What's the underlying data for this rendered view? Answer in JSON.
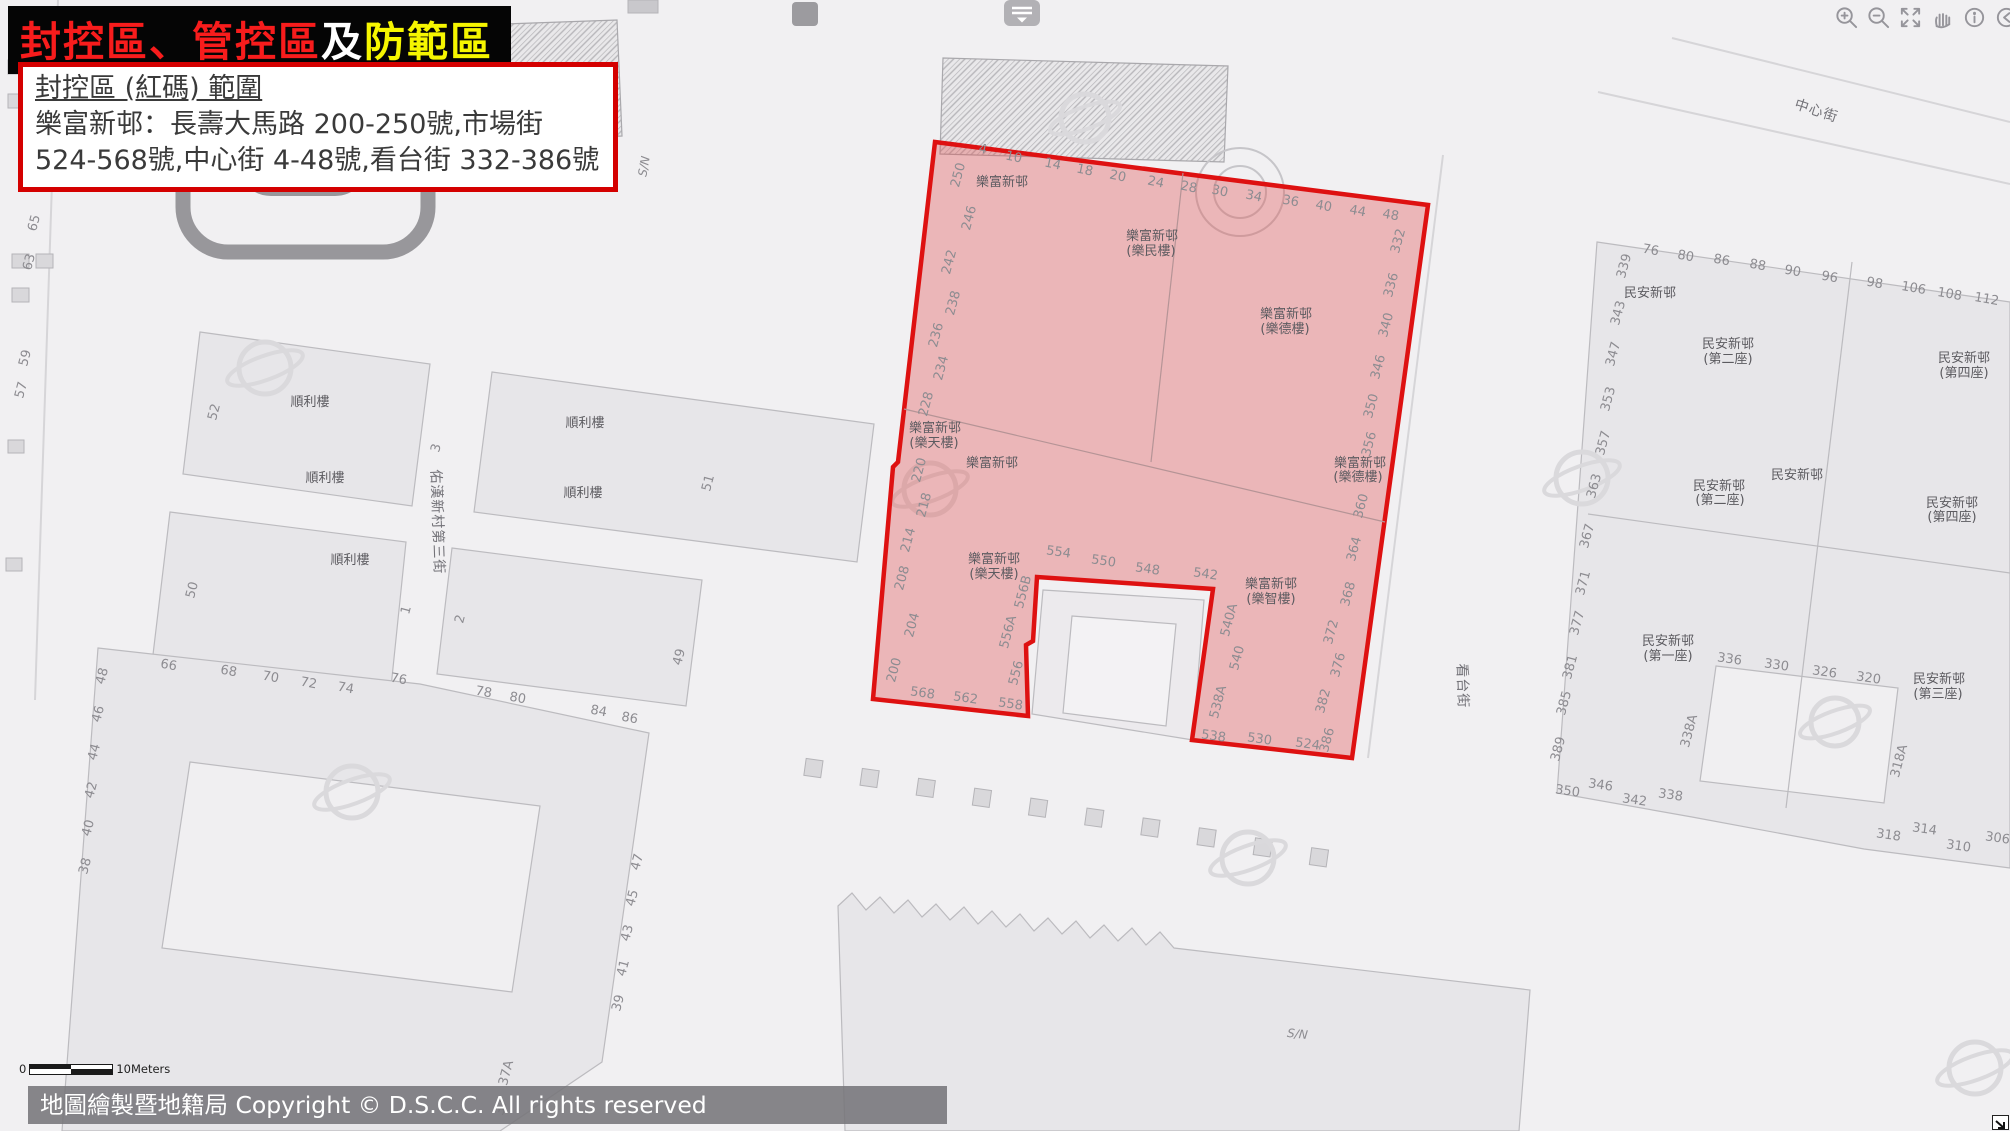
{
  "banner": {
    "red": "封控區、管控區",
    "white": "及",
    "yellow": "防範區"
  },
  "info_box": {
    "title": "封控區 (紅碼) 範圍",
    "line1": "樂富新邨：長壽大馬路 200-250號,市場街",
    "line2": "524-568號,中心街 4-48號,看台街 332-386號"
  },
  "toolbar": {
    "collapse_icon": "panel-collapse",
    "icons": [
      "zoom-in",
      "zoom-out",
      "full-extent",
      "pan-hand",
      "identify-info",
      "previous-extent",
      "next-extent"
    ]
  },
  "scalebar": {
    "zero": "0",
    "label": "10Meters"
  },
  "attribution": "地圖繪製暨地籍局 Copyright © D.S.C.C. All rights reserved",
  "colors": {
    "zone_fill": "rgba(225,80,80,0.36)",
    "zone_border": "#de1111",
    "banner_red": "#f81c1c",
    "banner_yellow": "#f6f600"
  },
  "map": {
    "zone_name": "封控區",
    "labels": [
      {
        "t": "4",
        "x": 982,
        "y": 153,
        "r": 12
      },
      {
        "t": "10",
        "x": 1013,
        "y": 161,
        "r": 12
      },
      {
        "t": "14",
        "x": 1052,
        "y": 168,
        "r": 12
      },
      {
        "t": "18",
        "x": 1084,
        "y": 174,
        "r": 12
      },
      {
        "t": "20",
        "x": 1117,
        "y": 180,
        "r": 12
      },
      {
        "t": "24",
        "x": 1155,
        "y": 186,
        "r": 12
      },
      {
        "t": "28",
        "x": 1188,
        "y": 191,
        "r": 12
      },
      {
        "t": "30",
        "x": 1219,
        "y": 195,
        "r": 12
      },
      {
        "t": "34",
        "x": 1253,
        "y": 200,
        "r": 12
      },
      {
        "t": "36",
        "x": 1290,
        "y": 205,
        "r": 10
      },
      {
        "t": "40",
        "x": 1323,
        "y": 210,
        "r": 10
      },
      {
        "t": "44",
        "x": 1357,
        "y": 215,
        "r": 10
      },
      {
        "t": "48",
        "x": 1390,
        "y": 219,
        "r": 10
      },
      {
        "t": "250",
        "x": 962,
        "y": 176,
        "r": -75
      },
      {
        "t": "246",
        "x": 973,
        "y": 219,
        "r": -75
      },
      {
        "t": "242",
        "x": 953,
        "y": 263,
        "r": -75
      },
      {
        "t": "238",
        "x": 957,
        "y": 304,
        "r": -75
      },
      {
        "t": "236",
        "x": 940,
        "y": 336,
        "r": -75
      },
      {
        "t": "234",
        "x": 945,
        "y": 369,
        "r": -75
      },
      {
        "t": "228",
        "x": 930,
        "y": 405,
        "r": -75
      },
      {
        "t": "220",
        "x": 923,
        "y": 471,
        "r": -75
      },
      {
        "t": "218",
        "x": 928,
        "y": 506,
        "r": -75
      },
      {
        "t": "214",
        "x": 912,
        "y": 541,
        "r": -75
      },
      {
        "t": "208",
        "x": 906,
        "y": 579,
        "r": -75
      },
      {
        "t": "204",
        "x": 916,
        "y": 626,
        "r": -75
      },
      {
        "t": "200",
        "x": 898,
        "y": 671,
        "r": -75
      },
      {
        "t": "568",
        "x": 922,
        "y": 697,
        "r": 8
      },
      {
        "t": "562",
        "x": 965,
        "y": 702,
        "r": 8
      },
      {
        "t": "558",
        "x": 1010,
        "y": 708,
        "r": 8
      },
      {
        "t": "556",
        "x": 1020,
        "y": 674,
        "r": -75
      },
      {
        "t": "556A",
        "x": 1012,
        "y": 633,
        "r": -75
      },
      {
        "t": "556B",
        "x": 1027,
        "y": 593,
        "r": -75
      },
      {
        "t": "554",
        "x": 1058,
        "y": 556,
        "r": 8
      },
      {
        "t": "550",
        "x": 1103,
        "y": 565,
        "r": 8
      },
      {
        "t": "548",
        "x": 1147,
        "y": 573,
        "r": 8
      },
      {
        "t": "542",
        "x": 1205,
        "y": 578,
        "r": 8
      },
      {
        "t": "540A",
        "x": 1233,
        "y": 621,
        "r": -75
      },
      {
        "t": "540",
        "x": 1241,
        "y": 659,
        "r": -75
      },
      {
        "t": "538A",
        "x": 1222,
        "y": 703,
        "r": -75
      },
      {
        "t": "538",
        "x": 1213,
        "y": 740,
        "r": 8
      },
      {
        "t": "530",
        "x": 1259,
        "y": 743,
        "r": 8
      },
      {
        "t": "524",
        "x": 1307,
        "y": 748,
        "r": 8
      },
      {
        "t": "386",
        "x": 1331,
        "y": 741,
        "r": -75
      },
      {
        "t": "382",
        "x": 1327,
        "y": 702,
        "r": -75
      },
      {
        "t": "376",
        "x": 1342,
        "y": 666,
        "r": -75
      },
      {
        "t": "372",
        "x": 1335,
        "y": 633,
        "r": -75
      },
      {
        "t": "368",
        "x": 1352,
        "y": 595,
        "r": -75
      },
      {
        "t": "364",
        "x": 1358,
        "y": 550,
        "r": -75
      },
      {
        "t": "360",
        "x": 1365,
        "y": 507,
        "r": -75
      },
      {
        "t": "356",
        "x": 1373,
        "y": 445,
        "r": -75
      },
      {
        "t": "350",
        "x": 1375,
        "y": 407,
        "r": -75
      },
      {
        "t": "346",
        "x": 1382,
        "y": 368,
        "r": -75
      },
      {
        "t": "340",
        "x": 1390,
        "y": 326,
        "r": -75
      },
      {
        "t": "336",
        "x": 1395,
        "y": 286,
        "r": -75
      },
      {
        "t": "332",
        "x": 1402,
        "y": 242,
        "r": -75
      },
      {
        "t": "樂富新邨",
        "x": 1002,
        "y": 186,
        "c": "bld"
      },
      {
        "t": "樂富新邨",
        "x": 1152,
        "y": 240,
        "c": "bld"
      },
      {
        "t": "(樂民樓)",
        "x": 1151,
        "y": 255,
        "c": "bld"
      },
      {
        "t": "樂富新邨",
        "x": 1286,
        "y": 318,
        "c": "bld"
      },
      {
        "t": "(樂德樓)",
        "x": 1285,
        "y": 333,
        "c": "bld"
      },
      {
        "t": "樂富新邨",
        "x": 935,
        "y": 432,
        "c": "bld"
      },
      {
        "t": "(樂天樓)",
        "x": 934,
        "y": 447,
        "c": "bld"
      },
      {
        "t": "樂富新邨",
        "x": 992,
        "y": 467,
        "c": "bld"
      },
      {
        "t": "樂富新邨",
        "x": 994,
        "y": 563,
        "c": "bld"
      },
      {
        "t": "(樂天樓)",
        "x": 994,
        "y": 578,
        "c": "bld"
      },
      {
        "t": "樂富新邨",
        "x": 1360,
        "y": 467,
        "c": "bld"
      },
      {
        "t": "(樂德樓)",
        "x": 1358,
        "y": 481,
        "c": "bld"
      },
      {
        "t": "樂富新邨",
        "x": 1271,
        "y": 588,
        "c": "bld"
      },
      {
        "t": "(樂智樓)",
        "x": 1271,
        "y": 603,
        "c": "bld"
      },
      {
        "t": "順利樓",
        "x": 310,
        "y": 406,
        "c": "bld"
      },
      {
        "t": "順利樓",
        "x": 325,
        "y": 482,
        "c": "bld"
      },
      {
        "t": "順利樓",
        "x": 585,
        "y": 427,
        "c": "bld"
      },
      {
        "t": "順利樓",
        "x": 583,
        "y": 497,
        "c": "bld"
      },
      {
        "t": "順利樓",
        "x": 350,
        "y": 564,
        "c": "bld"
      },
      {
        "t": "52",
        "x": 218,
        "y": 413,
        "r": -75
      },
      {
        "t": "3",
        "x": 440,
        "y": 449,
        "r": -75
      },
      {
        "t": "51",
        "x": 712,
        "y": 484,
        "r": -75
      },
      {
        "t": "50",
        "x": 196,
        "y": 591,
        "r": -75
      },
      {
        "t": "1",
        "x": 410,
        "y": 611,
        "r": -75
      },
      {
        "t": "2",
        "x": 464,
        "y": 620,
        "r": -75
      },
      {
        "t": "49",
        "x": 683,
        "y": 658,
        "r": -75
      },
      {
        "t": "65",
        "x": 38,
        "y": 224,
        "r": -75
      },
      {
        "t": "63",
        "x": 33,
        "y": 263,
        "r": -75
      },
      {
        "t": "59",
        "x": 29,
        "y": 359,
        "r": -75
      },
      {
        "t": "57",
        "x": 25,
        "y": 391,
        "r": -75
      },
      {
        "t": "66",
        "x": 168,
        "y": 669,
        "r": 10
      },
      {
        "t": "68",
        "x": 228,
        "y": 675,
        "r": 10
      },
      {
        "t": "70",
        "x": 270,
        "y": 681,
        "r": 10
      },
      {
        "t": "72",
        "x": 308,
        "y": 687,
        "r": 10
      },
      {
        "t": "74",
        "x": 345,
        "y": 692,
        "r": 10
      },
      {
        "t": "76",
        "x": 398,
        "y": 683,
        "r": 10
      },
      {
        "t": "78",
        "x": 483,
        "y": 696,
        "r": 10
      },
      {
        "t": "80",
        "x": 517,
        "y": 702,
        "r": 10
      },
      {
        "t": "84",
        "x": 598,
        "y": 715,
        "r": 10
      },
      {
        "t": "86",
        "x": 629,
        "y": 722,
        "r": 10
      },
      {
        "t": "48",
        "x": 106,
        "y": 677,
        "r": -75
      },
      {
        "t": "46",
        "x": 102,
        "y": 715,
        "r": -75
      },
      {
        "t": "44",
        "x": 98,
        "y": 753,
        "r": -75
      },
      {
        "t": "42",
        "x": 95,
        "y": 791,
        "r": -75
      },
      {
        "t": "40",
        "x": 92,
        "y": 829,
        "r": -75
      },
      {
        "t": "38",
        "x": 89,
        "y": 867,
        "r": -75
      },
      {
        "t": "47",
        "x": 641,
        "y": 863,
        "r": -75
      },
      {
        "t": "45",
        "x": 636,
        "y": 899,
        "r": -75
      },
      {
        "t": "43",
        "x": 631,
        "y": 934,
        "r": -75
      },
      {
        "t": "41",
        "x": 627,
        "y": 969,
        "r": -75
      },
      {
        "t": "39",
        "x": 622,
        "y": 1004,
        "r": -75
      },
      {
        "t": "37A",
        "x": 510,
        "y": 1074,
        "r": -75
      },
      {
        "t": "37",
        "x": 505,
        "y": 1108,
        "r": -75
      },
      {
        "t": "民安新邨",
        "x": 1650,
        "y": 297,
        "c": "bld"
      },
      {
        "t": "民安新邨",
        "x": 1728,
        "y": 348,
        "c": "bld"
      },
      {
        "t": "(第二座)",
        "x": 1728,
        "y": 363,
        "c": "bld"
      },
      {
        "t": "民安新邨",
        "x": 1964,
        "y": 362,
        "c": "bld"
      },
      {
        "t": "(第四座)",
        "x": 1964,
        "y": 377,
        "c": "bld"
      },
      {
        "t": "民安新邨",
        "x": 1797,
        "y": 479,
        "c": "bld"
      },
      {
        "t": "民安新邨",
        "x": 1719,
        "y": 490,
        "c": "bld"
      },
      {
        "t": "(第二座)",
        "x": 1720,
        "y": 504,
        "c": "bld"
      },
      {
        "t": "民安新邨",
        "x": 1952,
        "y": 507,
        "c": "bld"
      },
      {
        "t": "(第四座)",
        "x": 1952,
        "y": 521,
        "c": "bld"
      },
      {
        "t": "民安新邨",
        "x": 1668,
        "y": 645,
        "c": "bld"
      },
      {
        "t": "(第一座)",
        "x": 1668,
        "y": 660,
        "c": "bld"
      },
      {
        "t": "民安新邨",
        "x": 1939,
        "y": 683,
        "c": "bld"
      },
      {
        "t": "(第三座)",
        "x": 1938,
        "y": 698,
        "c": "bld"
      },
      {
        "t": "76",
        "x": 1650,
        "y": 254,
        "r": 10
      },
      {
        "t": "80",
        "x": 1685,
        "y": 260,
        "r": 10
      },
      {
        "t": "86",
        "x": 1721,
        "y": 264,
        "r": 10
      },
      {
        "t": "88",
        "x": 1757,
        "y": 269,
        "r": 10
      },
      {
        "t": "90",
        "x": 1792,
        "y": 275,
        "r": 10
      },
      {
        "t": "96",
        "x": 1829,
        "y": 281,
        "r": 10
      },
      {
        "t": "98",
        "x": 1874,
        "y": 287,
        "r": 10
      },
      {
        "t": "106",
        "x": 1913,
        "y": 292,
        "r": 10
      },
      {
        "t": "108",
        "x": 1949,
        "y": 298,
        "r": 10
      },
      {
        "t": "112",
        "x": 1986,
        "y": 303,
        "r": 10
      },
      {
        "t": "339",
        "x": 1628,
        "y": 267,
        "r": -75
      },
      {
        "t": "343",
        "x": 1622,
        "y": 314,
        "r": -75
      },
      {
        "t": "347",
        "x": 1617,
        "y": 355,
        "r": -75
      },
      {
        "t": "353",
        "x": 1612,
        "y": 400,
        "r": -75
      },
      {
        "t": "357",
        "x": 1607,
        "y": 444,
        "r": -75
      },
      {
        "t": "363",
        "x": 1598,
        "y": 487,
        "r": -75
      },
      {
        "t": "367",
        "x": 1591,
        "y": 537,
        "r": -75
      },
      {
        "t": "371",
        "x": 1587,
        "y": 584,
        "r": -75
      },
      {
        "t": "377",
        "x": 1581,
        "y": 624,
        "r": -75
      },
      {
        "t": "381",
        "x": 1574,
        "y": 668,
        "r": -75
      },
      {
        "t": "385",
        "x": 1568,
        "y": 704,
        "r": -75
      },
      {
        "t": "389",
        "x": 1562,
        "y": 750,
        "r": -75
      },
      {
        "t": "350",
        "x": 1567,
        "y": 795,
        "r": 8
      },
      {
        "t": "346",
        "x": 1600,
        "y": 789,
        "r": 8
      },
      {
        "t": "342",
        "x": 1634,
        "y": 804,
        "r": 8
      },
      {
        "t": "338",
        "x": 1670,
        "y": 799,
        "r": 8
      },
      {
        "t": "338A",
        "x": 1693,
        "y": 732,
        "r": -75
      },
      {
        "t": "336",
        "x": 1729,
        "y": 663,
        "r": 8
      },
      {
        "t": "330",
        "x": 1776,
        "y": 669,
        "r": 8
      },
      {
        "t": "326",
        "x": 1824,
        "y": 676,
        "r": 8
      },
      {
        "t": "320",
        "x": 1868,
        "y": 682,
        "r": 8
      },
      {
        "t": "318A",
        "x": 1903,
        "y": 762,
        "r": -75
      },
      {
        "t": "318",
        "x": 1888,
        "y": 839,
        "r": 8
      },
      {
        "t": "314",
        "x": 1924,
        "y": 833,
        "r": 8
      },
      {
        "t": "310",
        "x": 1958,
        "y": 850,
        "r": 8
      },
      {
        "t": "306",
        "x": 1997,
        "y": 842,
        "r": 8
      },
      {
        "t": "中心街",
        "x": 1815,
        "y": 115,
        "r": 18,
        "c": "street"
      },
      {
        "t": "佑漢新村第三街",
        "x": 433,
        "y": 522,
        "r": 88,
        "c": "street"
      },
      {
        "t": "看台街",
        "x": 1458,
        "y": 686,
        "r": 88,
        "c": "street"
      },
      {
        "t": "S/N",
        "x": 1297,
        "y": 1038,
        "r": 6,
        "c": "sn"
      },
      {
        "t": "S/N",
        "x": 648,
        "y": 167,
        "r": -80,
        "c": "sn"
      }
    ]
  }
}
